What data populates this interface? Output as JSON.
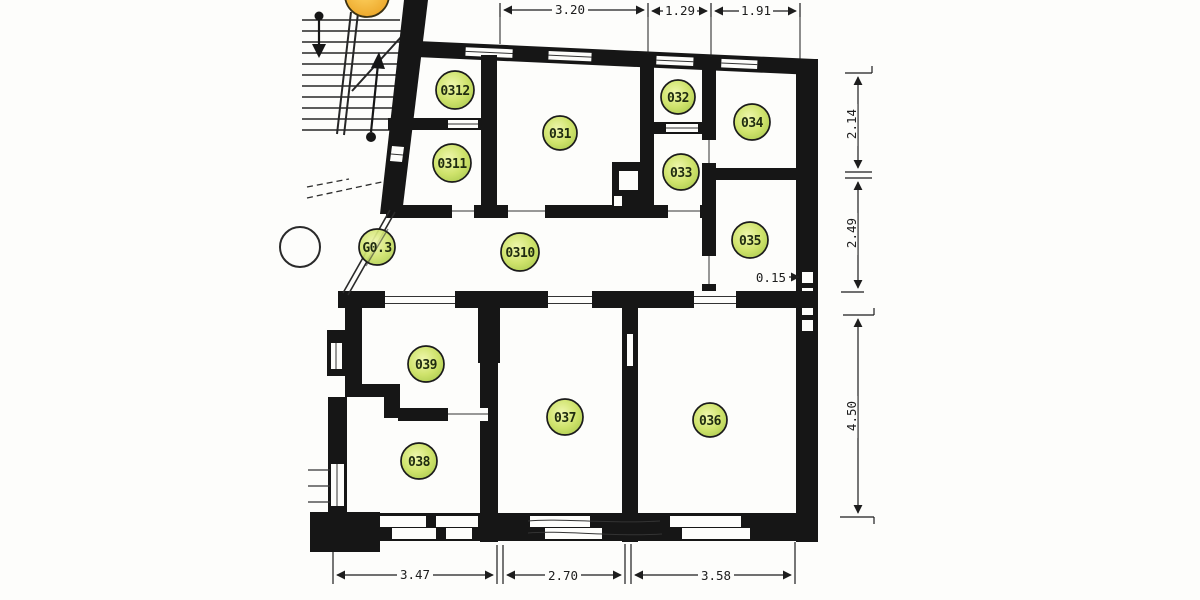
{
  "plan": {
    "rooms": [
      {
        "id": "0312",
        "label": "0312"
      },
      {
        "id": "0311",
        "label": "0311"
      },
      {
        "id": "031",
        "label": "031"
      },
      {
        "id": "032",
        "label": "032"
      },
      {
        "id": "033",
        "label": "033"
      },
      {
        "id": "034",
        "label": "034"
      },
      {
        "id": "035",
        "label": "035"
      },
      {
        "id": "G0.3",
        "label": "G0.3"
      },
      {
        "id": "0310",
        "label": "0310"
      },
      {
        "id": "039",
        "label": "039"
      },
      {
        "id": "038",
        "label": "038"
      },
      {
        "id": "037",
        "label": "037"
      },
      {
        "id": "036",
        "label": "036"
      }
    ],
    "dimensions": {
      "top": [
        "3.20",
        "1.29",
        "1.91"
      ],
      "right": [
        "2.14",
        "2.49",
        "4.50"
      ],
      "bottom": [
        "3.47",
        "2.70",
        "3.58"
      ],
      "wall_thickness": "0.15"
    },
    "colors": {
      "wall": "#1a1a1a",
      "room_badge_fill": "#cfe36c",
      "partial_badge_fill": "#f2a93b",
      "paper": "#fdfdfb"
    }
  }
}
